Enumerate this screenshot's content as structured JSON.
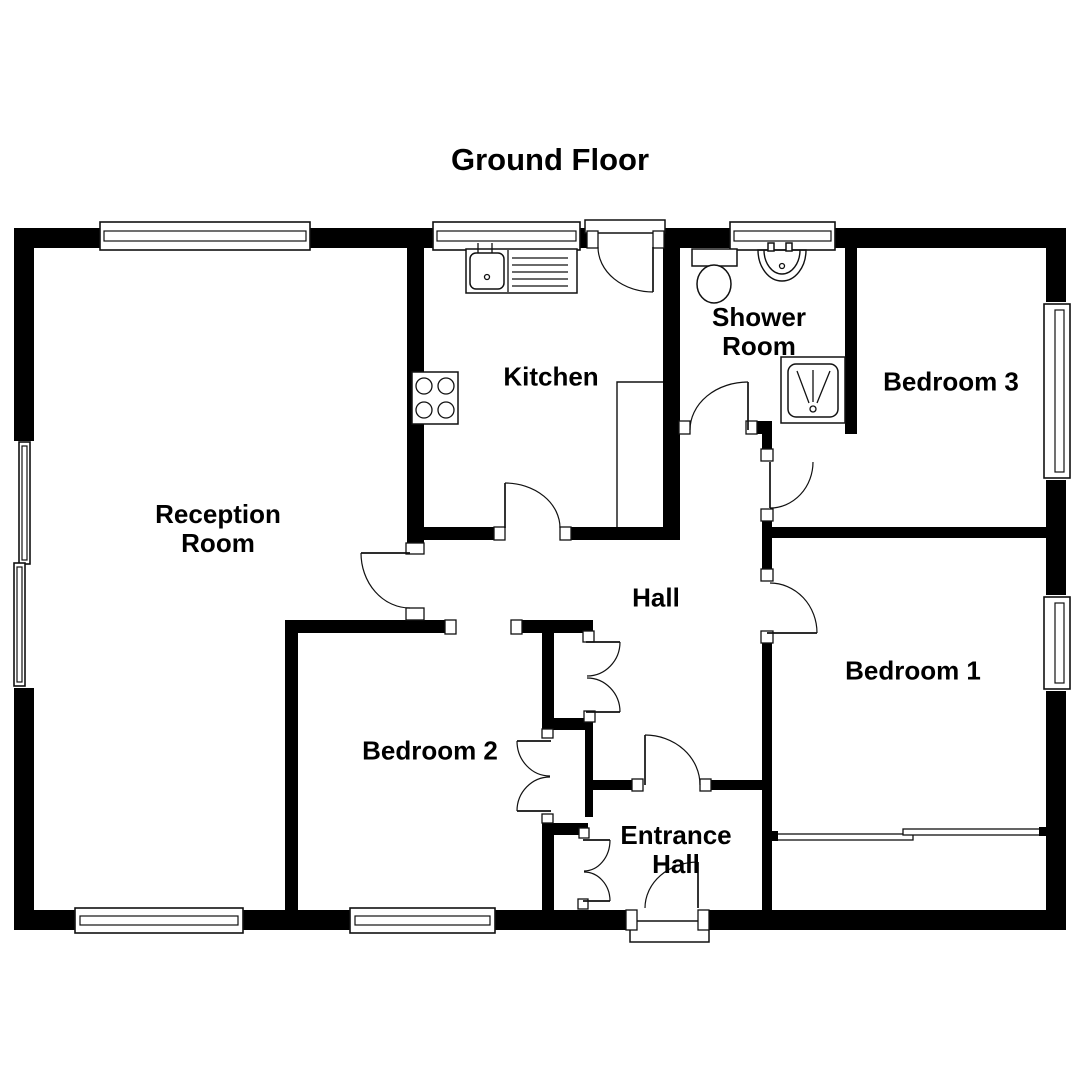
{
  "title": "Ground Floor",
  "plan": {
    "canvas": {
      "width": 1080,
      "height": 1080
    },
    "colors": {
      "wall": "#000000",
      "line": "#111111",
      "background": "#ffffff"
    },
    "rooms": [
      {
        "name": "Reception Room"
      },
      {
        "name": "Kitchen"
      },
      {
        "name": "Shower Room"
      },
      {
        "name": "Bedroom 3"
      },
      {
        "name": "Hall"
      },
      {
        "name": "Bedroom 1"
      },
      {
        "name": "Bedroom 2"
      },
      {
        "name": "Entrance Hall"
      }
    ],
    "walls": [
      {
        "n": "top-exterior-wall",
        "r": [
          14,
          228,
          1052,
          20
        ]
      },
      {
        "n": "bottom-exterior-wall",
        "r": [
          14,
          910,
          1052,
          20
        ]
      },
      {
        "n": "left-exterior-wall",
        "r": [
          14,
          228,
          20,
          702
        ]
      },
      {
        "n": "right-exterior-wall",
        "r": [
          1046,
          228,
          20,
          702
        ]
      },
      {
        "n": "kitchen-west-wall",
        "r": [
          407,
          248,
          17,
          297
        ]
      },
      {
        "n": "kitchen-south-wall",
        "r": [
          407,
          527,
          273,
          13
        ]
      },
      {
        "n": "kitchen-east-wall",
        "r": [
          663,
          248,
          17,
          292
        ]
      },
      {
        "n": "shower-south-wall",
        "r": [
          663,
          421,
          109,
          13
        ]
      },
      {
        "n": "shower-east-wall",
        "r": [
          845,
          248,
          12,
          186
        ]
      },
      {
        "n": "bedroom3-south-wall",
        "r": [
          762,
          527,
          284,
          11
        ]
      },
      {
        "n": "hall-east-wall",
        "r": [
          762,
          434,
          10,
          476
        ]
      },
      {
        "n": "entrance-hall-north-wall",
        "r": [
          590,
          780,
          172,
          10
        ]
      },
      {
        "n": "bedroom2-north-wall",
        "r": [
          285,
          620,
          308,
          13
        ]
      },
      {
        "n": "bedroom2-west-wall",
        "r": [
          285,
          620,
          13,
          290
        ]
      },
      {
        "n": "bedroom2-east-wall-upper",
        "r": [
          542,
          620,
          12,
          110
        ]
      },
      {
        "n": "cupboard-mid-wall",
        "r": [
          585,
          718,
          8,
          99
        ]
      },
      {
        "n": "cupboard-south-wall",
        "r": [
          542,
          823,
          46,
          12
        ]
      },
      {
        "n": "bedroom2-east-wall-lower",
        "r": [
          542,
          823,
          12,
          87
        ]
      },
      {
        "n": "hall-cupboard-south-wall",
        "r": [
          554,
          718,
          39,
          12
        ]
      }
    ],
    "punches": [
      {
        "n": "left-window-gap",
        "r": [
          13,
          441,
          23,
          247
        ]
      },
      {
        "n": "right-window-gap-bedroom3",
        "r": [
          1045,
          302,
          22,
          178
        ]
      },
      {
        "n": "right-window-gap-bedroom1",
        "r": [
          1045,
          595,
          22,
          96
        ]
      },
      {
        "n": "kitchen-back-door-gap",
        "r": [
          597,
          231,
          57,
          18
        ]
      },
      {
        "n": "kitchen-hall-door-gap",
        "r": [
          504,
          526,
          57,
          15
        ]
      },
      {
        "n": "reception-door-gap",
        "r": [
          405,
          553,
          21,
          55
        ]
      },
      {
        "n": "shower-door-gap",
        "r": [
          689,
          421,
          58,
          13
        ]
      },
      {
        "n": "bedroom2-door-gap",
        "r": [
          456,
          619,
          56,
          15
        ]
      },
      {
        "n": "bedroom3-door-gap",
        "r": [
          760,
          461,
          14,
          49
        ]
      },
      {
        "n": "bedroom1-door-gap",
        "r": [
          760,
          581,
          14,
          51
        ]
      },
      {
        "n": "entrance-inner-door-gap",
        "r": [
          642,
          779,
          59,
          12
        ]
      },
      {
        "n": "front-door-gap",
        "r": [
          636,
          909,
          63,
          22
        ]
      }
    ],
    "windows": [
      {
        "n": "window-top-reception",
        "outer": [
          100,
          222,
          210,
          28
        ],
        "inner": [
          104,
          231,
          202,
          10
        ]
      },
      {
        "n": "window-top-kitchen",
        "outer": [
          433,
          222,
          147,
          28
        ],
        "inner": [
          437,
          231,
          139,
          10
        ]
      },
      {
        "n": "window-top-shower",
        "outer": [
          730,
          222,
          105,
          28
        ],
        "inner": [
          734,
          231,
          97,
          10
        ]
      },
      {
        "n": "window-bottom-reception",
        "outer": [
          75,
          908,
          168,
          25
        ],
        "inner": [
          80,
          916,
          158,
          9
        ]
      },
      {
        "n": "window-bottom-bedroom2",
        "outer": [
          350,
          908,
          145,
          25
        ],
        "inner": [
          355,
          916,
          135,
          9
        ]
      },
      {
        "n": "window-left-upper",
        "outer": [
          19,
          442,
          11,
          122
        ],
        "inner": [
          22,
          446,
          5,
          114
        ]
      },
      {
        "n": "window-left-lower",
        "outer": [
          14,
          563,
          11,
          123
        ],
        "inner": [
          17,
          567,
          5,
          115
        ]
      },
      {
        "n": "window-right-bedroom3",
        "outer": [
          1044,
          304,
          26,
          174
        ],
        "inner": [
          1055,
          310,
          9,
          162
        ]
      },
      {
        "n": "window-right-bedroom1",
        "outer": [
          1044,
          597,
          26,
          92
        ],
        "inner": [
          1055,
          603,
          9,
          80
        ]
      }
    ],
    "white_boxes": [
      {
        "n": "back-door-recess",
        "r": [
          585,
          220,
          80,
          13
        ]
      },
      {
        "n": "front-porch-step",
        "r": [
          630,
          921,
          79,
          21
        ]
      }
    ],
    "jambs": [
      {
        "n": "jamb",
        "r": [
          587,
          231,
          11,
          17
        ]
      },
      {
        "n": "jamb",
        "r": [
          653,
          231,
          11,
          17
        ]
      },
      {
        "n": "jamb",
        "r": [
          494,
          527,
          11,
          13
        ]
      },
      {
        "n": "jamb",
        "r": [
          560,
          527,
          11,
          13
        ]
      },
      {
        "n": "jamb",
        "r": [
          406,
          543,
          18,
          11
        ]
      },
      {
        "n": "jamb",
        "r": [
          406,
          608,
          18,
          12
        ]
      },
      {
        "n": "jamb",
        "r": [
          679,
          421,
          11,
          13
        ]
      },
      {
        "n": "jamb",
        "r": [
          746,
          421,
          11,
          13
        ]
      },
      {
        "n": "jamb",
        "r": [
          445,
          620,
          11,
          14
        ]
      },
      {
        "n": "jamb",
        "r": [
          511,
          620,
          11,
          14
        ]
      },
      {
        "n": "jamb",
        "r": [
          761,
          449,
          12,
          12
        ]
      },
      {
        "n": "jamb",
        "r": [
          761,
          509,
          12,
          12
        ]
      },
      {
        "n": "jamb",
        "r": [
          761,
          569,
          12,
          12
        ]
      },
      {
        "n": "jamb",
        "r": [
          761,
          631,
          12,
          12
        ]
      },
      {
        "n": "jamb",
        "r": [
          632,
          779,
          11,
          12
        ]
      },
      {
        "n": "jamb",
        "r": [
          700,
          779,
          11,
          12
        ]
      },
      {
        "n": "jamb",
        "r": [
          626,
          910,
          11,
          20
        ]
      },
      {
        "n": "jamb",
        "r": [
          698,
          910,
          11,
          20
        ]
      },
      {
        "n": "jamb",
        "r": [
          583,
          631,
          11,
          11
        ]
      },
      {
        "n": "jamb",
        "r": [
          584,
          711,
          11,
          11
        ]
      },
      {
        "n": "jamb",
        "r": [
          542,
          729,
          11,
          9
        ]
      },
      {
        "n": "jamb",
        "r": [
          542,
          814,
          11,
          9
        ]
      },
      {
        "n": "jamb",
        "r": [
          579,
          828,
          10,
          10
        ]
      },
      {
        "n": "jamb",
        "r": [
          578,
          899,
          10,
          10
        ]
      }
    ],
    "doors": [
      {
        "n": "kitchen-back-door",
        "leaf": [
          653,
          247,
          653,
          292
        ],
        "arc": "M598,247 A55,45 0 0 0 653,292"
      },
      {
        "n": "kitchen-hall-door",
        "leaf": [
          505,
          528,
          505,
          483
        ],
        "arc": "M505,483 A55,45 0 0 1 560,528"
      },
      {
        "n": "reception-hall-door",
        "leaf": [
          410,
          553,
          361,
          553
        ],
        "arc": "M361,553 A49,55 0 0 0 410,608"
      },
      {
        "n": "shower-room-door",
        "leaf": [
          748,
          430,
          748,
          382
        ],
        "arc": "M748,382 A58,48 0 0 0 690,430"
      },
      {
        "n": "bedroom3-door",
        "leaf": [
          770,
          462,
          770,
          508
        ],
        "arc": "M770,508 A43,46 0 0 0 813,462"
      },
      {
        "n": "bedroom1-door",
        "leaf": [
          767,
          633,
          817,
          633
        ],
        "arc": "M770,583 A47,50 0 0 1 817,633"
      },
      {
        "n": "hall-entrance-door",
        "leaf": [
          645,
          785,
          645,
          735
        ],
        "arc": "M645,735 A55,50 0 0 1 700,785"
      },
      {
        "n": "front-door",
        "leaf": [
          698,
          908,
          698,
          862
        ],
        "arc": "M698,862 A53,46 0 0 0 645,908"
      },
      {
        "n": "hall-cupboard-door-top",
        "leaf": [
          586,
          642,
          620,
          642
        ],
        "arc": "M620,642 A33,34 0 0 1 587,676"
      },
      {
        "n": "hall-cupboard-door-bottom",
        "leaf": [
          586,
          712,
          620,
          712
        ],
        "arc": "M620,712 A33,34 0 0 0 587,678"
      },
      {
        "n": "bedroom2-wardrobe-door-top",
        "leaf": [
          551,
          741,
          517,
          741
        ],
        "arc": "M517,741 A33,35 0 0 0 550,776"
      },
      {
        "n": "bedroom2-wardrobe-door-bottom",
        "leaf": [
          551,
          811,
          517,
          811
        ],
        "arc": "M517,811 A33,34 0 0 1 550,777"
      },
      {
        "n": "entrance-cupboard-door-top",
        "leaf": [
          583,
          840,
          610,
          840
        ],
        "arc": "M610,840 A26,31 0 0 1 584,871"
      },
      {
        "n": "entrance-cupboard-door-bottom",
        "leaf": [
          583,
          901,
          610,
          901
        ],
        "arc": "M610,901 A26,29 0 0 0 584,872"
      }
    ],
    "primitives": [
      {
        "n": "kitchen-counter",
        "t": "rect",
        "a": [
          466,
          249,
          111,
          44
        ]
      },
      {
        "n": "kitchen-counter-divider",
        "t": "line",
        "a": [
          508,
          250,
          508,
          292
        ]
      },
      {
        "n": "kitchen-sink",
        "t": "rrect",
        "a": [
          470,
          253,
          34,
          36,
          6
        ]
      },
      {
        "n": "kitchen-sink-drain",
        "t": "circle",
        "a": [
          487,
          277,
          2.5
        ]
      },
      {
        "n": "kitchen-tap",
        "t": "line",
        "a": [
          478,
          243,
          478,
          253
        ]
      },
      {
        "n": "kitchen-tap",
        "t": "line",
        "a": [
          492,
          243,
          492,
          253
        ]
      },
      {
        "n": "kitchen-drainer-line",
        "t": "line",
        "a": [
          512,
          258,
          568,
          258
        ]
      },
      {
        "n": "kitchen-drainer-line",
        "t": "line",
        "a": [
          512,
          265,
          568,
          265
        ]
      },
      {
        "n": "kitchen-drainer-line",
        "t": "line",
        "a": [
          512,
          272,
          568,
          272
        ]
      },
      {
        "n": "kitchen-drainer-line",
        "t": "line",
        "a": [
          512,
          279,
          568,
          279
        ]
      },
      {
        "n": "kitchen-drainer-line",
        "t": "line",
        "a": [
          512,
          286,
          568,
          286
        ]
      },
      {
        "n": "kitchen-hob",
        "t": "rect",
        "a": [
          412,
          372,
          46,
          52
        ]
      },
      {
        "n": "hob-burner",
        "t": "circle",
        "a": [
          424,
          386,
          8
        ]
      },
      {
        "n": "hob-burner",
        "t": "circle",
        "a": [
          446,
          386,
          8
        ]
      },
      {
        "n": "hob-burner",
        "t": "circle",
        "a": [
          424,
          410,
          8
        ]
      },
      {
        "n": "hob-burner",
        "t": "circle",
        "a": [
          446,
          410,
          8
        ]
      },
      {
        "n": "kitchen-cupboard-outline",
        "t": "path",
        "d": "M617,527 L617,382 L663,382"
      },
      {
        "n": "toilet-cistern",
        "t": "rect",
        "a": [
          692,
          249,
          45,
          17
        ]
      },
      {
        "n": "toilet-bowl",
        "t": "ellipse",
        "a": [
          714,
          284,
          17,
          19
        ]
      },
      {
        "n": "basin",
        "t": "path",
        "d": "M758,250 L806,250 A24,31 0 0 1 758,250 Z"
      },
      {
        "n": "basin-inner",
        "t": "path",
        "d": "M764,250 A18,24 0 0 0 800,250"
      },
      {
        "n": "basin-tap",
        "t": "rect",
        "a": [
          768,
          243,
          6,
          8
        ]
      },
      {
        "n": "basin-tap",
        "t": "rect",
        "a": [
          786,
          243,
          6,
          8
        ]
      },
      {
        "n": "basin-drain",
        "t": "circle",
        "a": [
          782,
          266,
          2.5
        ]
      },
      {
        "n": "shower-tray",
        "t": "rect",
        "a": [
          781,
          357,
          64,
          66
        ]
      },
      {
        "n": "shower-tray-inner",
        "t": "rrect",
        "a": [
          788,
          364,
          50,
          53,
          8
        ]
      },
      {
        "n": "shower-spray-line",
        "t": "line",
        "a": [
          797,
          371,
          809,
          403
        ]
      },
      {
        "n": "shower-spray-line",
        "t": "line",
        "a": [
          813,
          370,
          813,
          402
        ]
      },
      {
        "n": "shower-spray-line",
        "t": "line",
        "a": [
          830,
          371,
          817,
          403
        ]
      },
      {
        "n": "shower-drain",
        "t": "circle",
        "a": [
          813,
          409,
          3
        ]
      },
      {
        "n": "bedroom1-partition",
        "t": "wrect",
        "a": [
          772,
          834,
          141,
          6
        ]
      },
      {
        "n": "bedroom1-partition",
        "t": "wrect",
        "a": [
          903,
          829,
          142,
          6
        ]
      },
      {
        "n": "partition-cap",
        "t": "brect",
        "a": [
          771,
          831,
          7,
          10
        ]
      },
      {
        "n": "partition-cap",
        "t": "brect",
        "a": [
          1039,
          827,
          7,
          9
        ]
      }
    ]
  }
}
